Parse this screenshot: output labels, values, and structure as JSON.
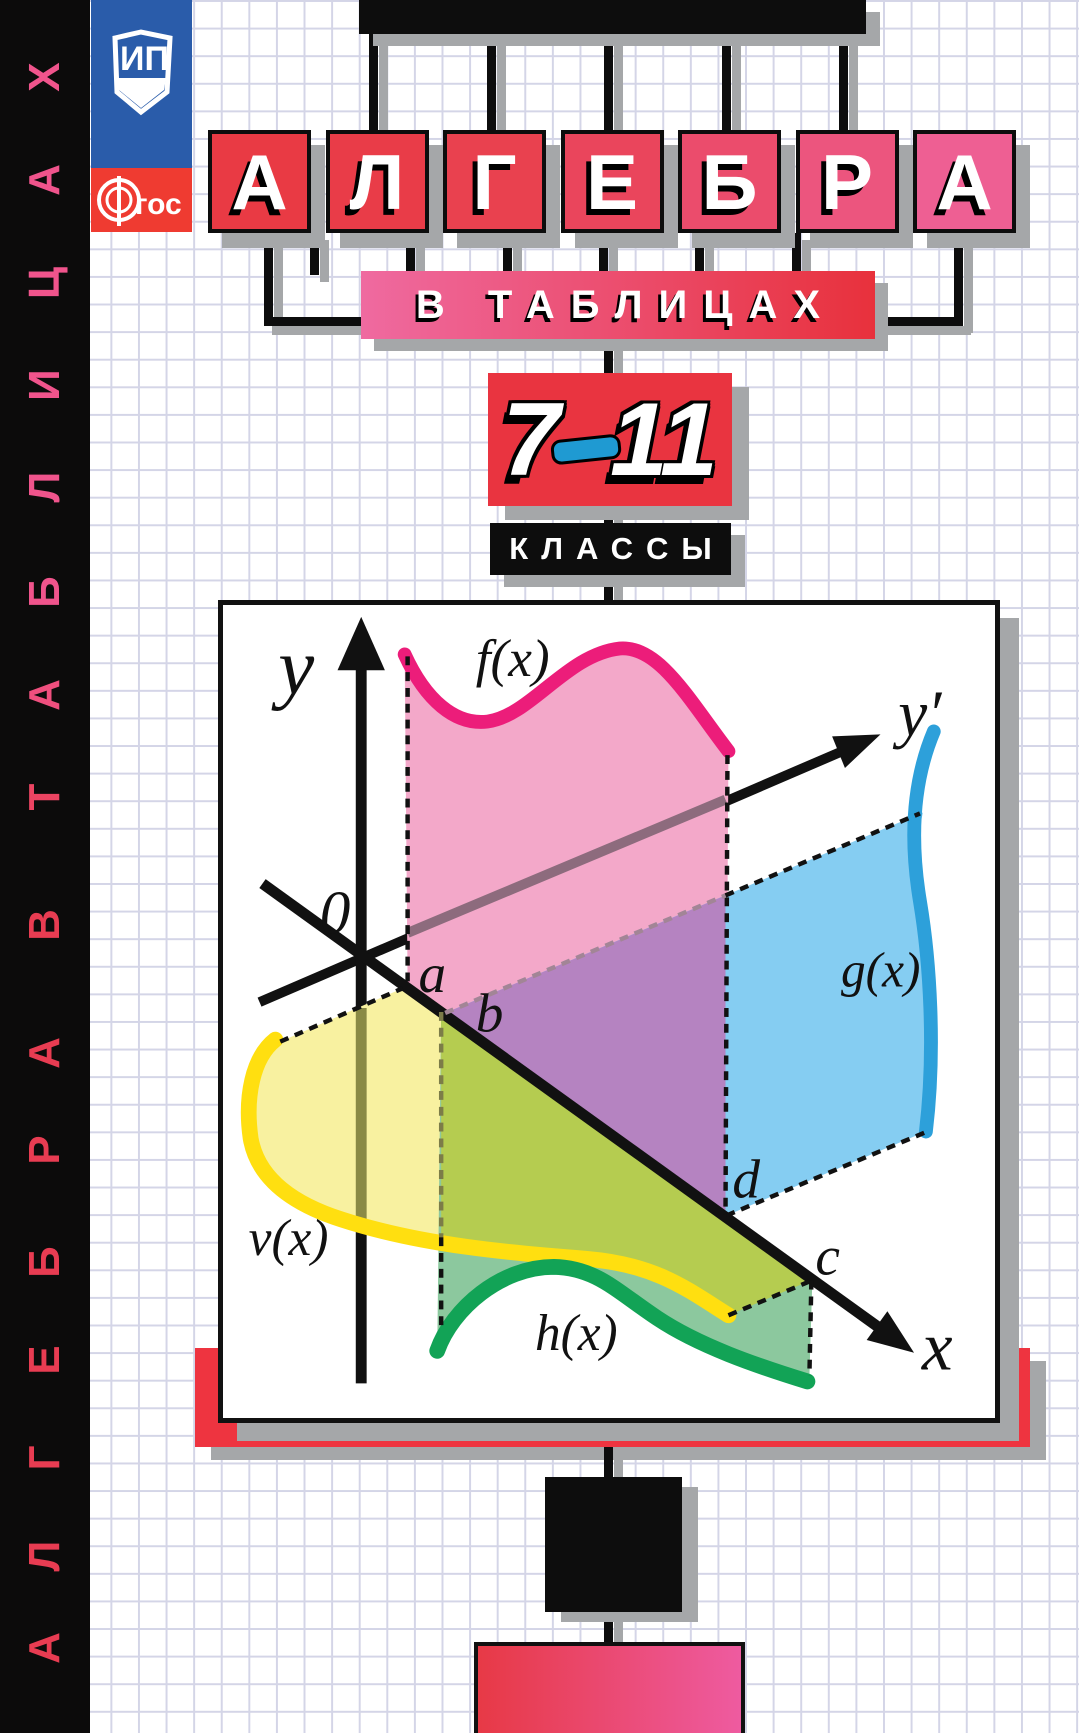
{
  "cover": {
    "title_word": "АЛГЕБРА",
    "subtitle": "В ТАБЛИЦАХ",
    "grades": {
      "from": "7",
      "to": "11"
    },
    "classes_label": "КЛАССЫ"
  },
  "left_strip": {
    "full_text": "АЛГЕБРА В ТАБЛИЦАХ",
    "letters": [
      {
        "ch": "Х",
        "y": 77,
        "color": "#f0548c"
      },
      {
        "ch": "А",
        "y": 180,
        "color": "#f0548c"
      },
      {
        "ch": "Ц",
        "y": 283,
        "color": "#f0548c"
      },
      {
        "ch": "И",
        "y": 385,
        "color": "#f0548c"
      },
      {
        "ch": "Л",
        "y": 487,
        "color": "#f0548c"
      },
      {
        "ch": "Б",
        "y": 592,
        "color": "#f0548c"
      },
      {
        "ch": "А",
        "y": 695,
        "color": "#ef4f7e"
      },
      {
        "ch": "Т",
        "y": 797,
        "color": "#ec4462"
      },
      {
        "ch": "В",
        "y": 925,
        "color": "#e83c52"
      },
      {
        "ch": "А",
        "y": 1053,
        "color": "#e83c52"
      },
      {
        "ch": "Р",
        "y": 1150,
        "color": "#e83c52"
      },
      {
        "ch": "Б",
        "y": 1262,
        "color": "#e83c52"
      },
      {
        "ch": "Е",
        "y": 1360,
        "color": "#e83c52"
      },
      {
        "ch": "Г",
        "y": 1458,
        "color": "#e83c52"
      },
      {
        "ch": "Л",
        "y": 1556,
        "color": "#e83c52"
      },
      {
        "ch": "А",
        "y": 1648,
        "color": "#e83c52"
      }
    ]
  },
  "logos": {
    "publisher_initials": "ИП",
    "fgos_f": "Ф",
    "fgos_rest": "гос"
  },
  "title_tiles": [
    {
      "ch": "А",
      "color": "#e93a44"
    },
    {
      "ch": "Л",
      "color": "#e93c48"
    },
    {
      "ch": "Г",
      "color": "#e9414f"
    },
    {
      "ch": "Е",
      "color": "#ea455c"
    },
    {
      "ch": "Б",
      "color": "#eb4c6c"
    },
    {
      "ch": "Р",
      "color": "#ec557e"
    },
    {
      "ch": "А",
      "color": "#ee5f93"
    }
  ],
  "diagram_labels": {
    "y_axis": "y",
    "y_prime_axis": "y′",
    "x_axis": "x",
    "origin": "0",
    "point_a": "a",
    "point_b": "b",
    "point_c": "c",
    "point_d": "d",
    "curve_f": "f(x)",
    "curve_g": "g(x)",
    "curve_v": "v(x)",
    "curve_h": "h(x)"
  },
  "colors": {
    "pink_fill": "#f3a8c9",
    "pink_curve": "#ec1d7a",
    "blue_fill": "#85cdf2",
    "blue_curve": "#2da0da",
    "purple_overlap": "#b583c1",
    "yellow_fill": "#f8f1a0",
    "yellow_curve": "#ffdf10",
    "green_fill": "#8cc89e",
    "green_curve": "#12a356",
    "olive_overlap": "#b5cc50",
    "red_block": "#e93440",
    "shadow_gray": "#a5a7a9"
  }
}
